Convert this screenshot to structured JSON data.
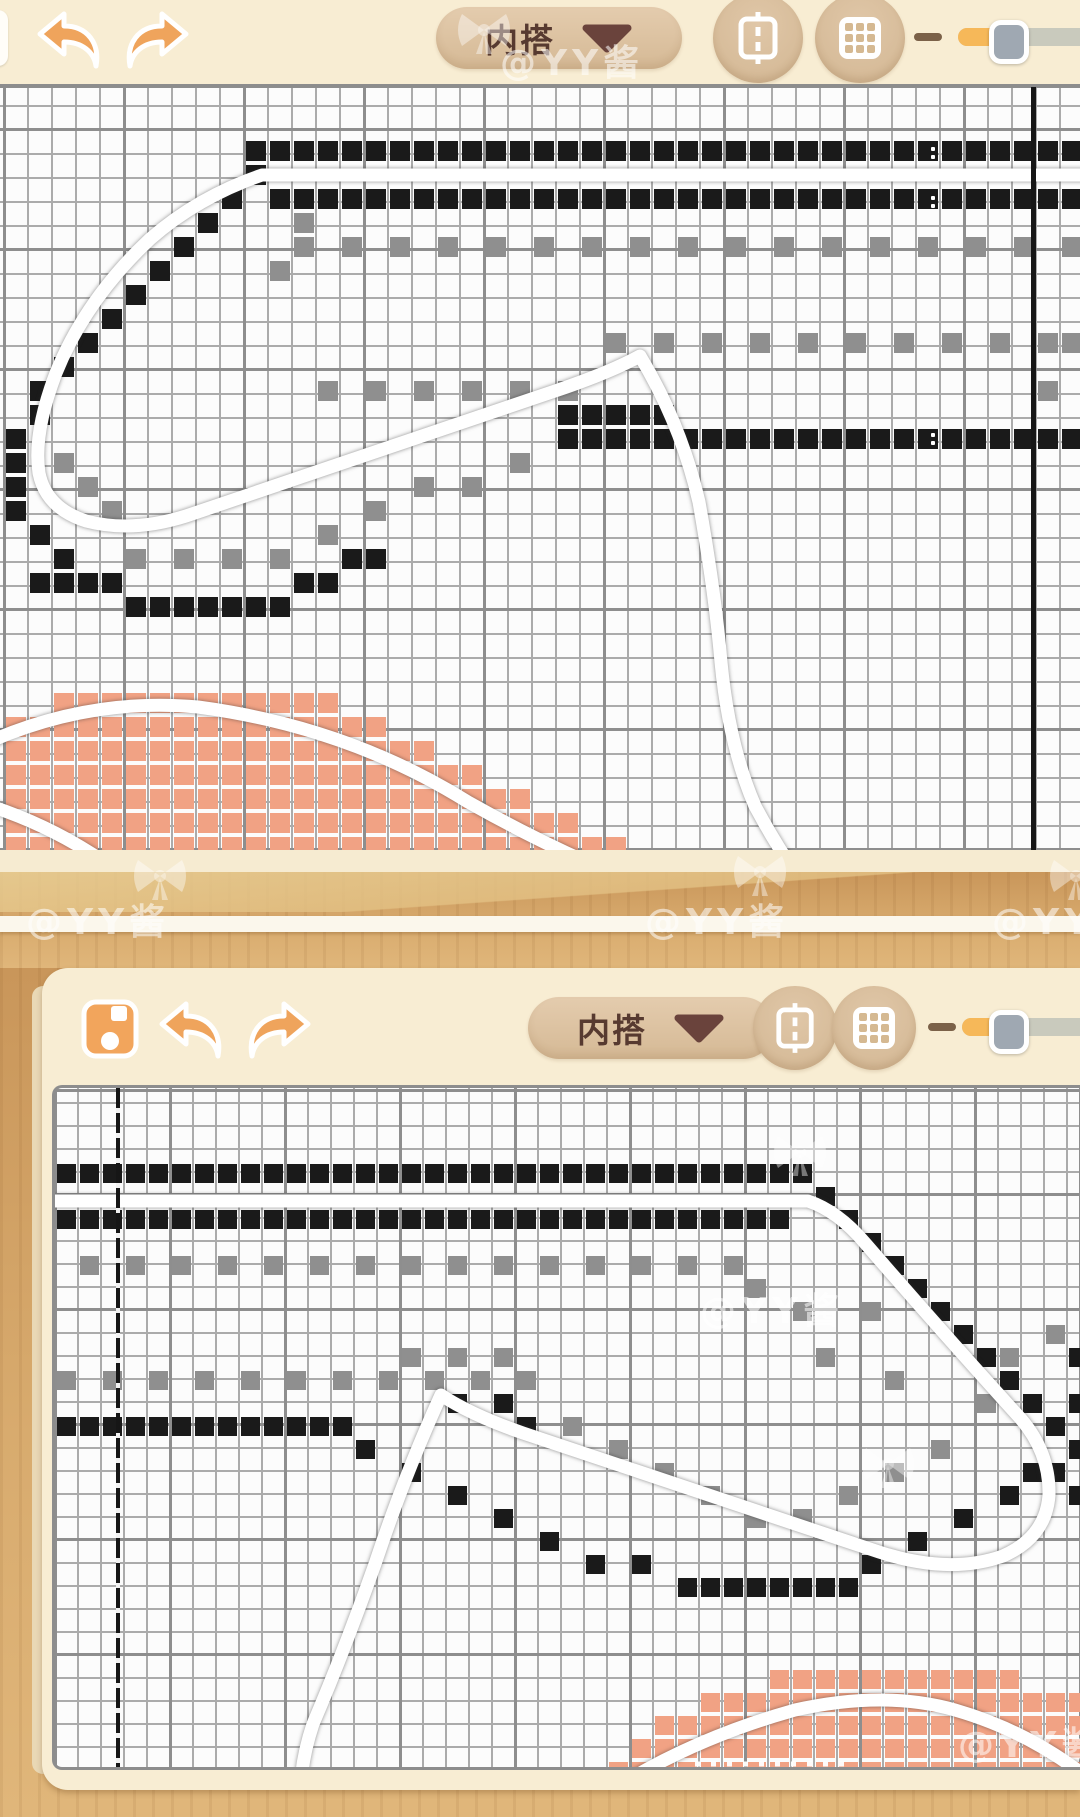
{
  "app": {
    "watermark_text": "@YY酱"
  },
  "colors": {
    "cream": "#f8edd3",
    "tan": "#d5b995",
    "dark_brown": "#573a30",
    "accent_orange": "#efa45c",
    "cell_black": "#1a1a1a",
    "cell_gray": "#8f8f8f",
    "cell_orange": "#f1a284",
    "wood": "#d8ab6e",
    "slider_fill": "#f6b859",
    "slider_track": "#c9cabd",
    "slider_thumb": "#9fa8b2",
    "white_line": "#ffffff"
  },
  "panel1": {
    "toolbar": {
      "layer_label": "内搭",
      "slider_percent": 30
    },
    "canvas": {
      "cell": 24,
      "origin_x": 4,
      "origin_y": 4,
      "cols": 45,
      "marker_line_x": 1031,
      "dot_marks": [
        [
          931,
          60
        ],
        [
          931,
          68
        ],
        [
          931,
          109
        ],
        [
          931,
          117
        ],
        [
          931,
          346
        ],
        [
          931,
          354
        ]
      ],
      "pattern": {
        "black_runs": [
          [
            2,
            10,
            44
          ],
          [
            4,
            11,
            44
          ],
          [
            13,
            24,
            27
          ],
          [
            14,
            23,
            44
          ],
          [
            21,
            6,
            11
          ]
        ],
        "black_cells": [
          [
            10,
            3
          ],
          [
            9,
            4
          ],
          [
            8,
            5
          ],
          [
            7,
            6
          ],
          [
            6,
            7
          ],
          [
            5,
            8
          ],
          [
            4,
            9
          ],
          [
            3,
            10
          ],
          [
            2,
            11
          ],
          [
            1,
            12
          ],
          [
            1,
            13
          ],
          [
            0,
            14
          ],
          [
            0,
            15
          ],
          [
            0,
            16
          ],
          [
            0,
            17
          ],
          [
            1,
            18
          ],
          [
            2,
            19
          ],
          [
            1,
            20
          ],
          [
            2,
            20
          ],
          [
            3,
            20
          ],
          [
            4,
            20
          ],
          [
            5,
            21
          ],
          [
            12,
            20
          ],
          [
            13,
            20
          ],
          [
            14,
            19
          ],
          [
            15,
            19
          ],
          [
            23,
            13
          ]
        ],
        "gray_runs": [
          [
            6,
            12,
            44,
            2
          ],
          [
            10,
            25,
            43,
            2
          ],
          [
            12,
            13,
            23,
            2
          ],
          [
            19,
            5,
            11,
            2
          ]
        ],
        "gray_cells": [
          [
            12,
            5
          ],
          [
            11,
            7
          ],
          [
            2,
            15
          ],
          [
            3,
            16
          ],
          [
            4,
            17
          ],
          [
            13,
            18
          ],
          [
            15,
            17
          ],
          [
            17,
            16
          ],
          [
            19,
            16
          ],
          [
            21,
            15
          ],
          [
            44,
            10
          ],
          [
            43,
            12
          ]
        ],
        "orange_runs": [
          [
            25,
            2,
            13
          ],
          [
            26,
            0,
            15
          ],
          [
            27,
            0,
            17
          ],
          [
            28,
            0,
            19
          ],
          [
            29,
            0,
            21
          ],
          [
            30,
            0,
            23
          ],
          [
            31,
            0,
            25
          ]
        ]
      },
      "white_paths": [
        {
          "d": "M 1092,88 L 262,88 Q 198,110 150,152 Q 86,212 56,286 Q 33,346 39,386 Q 46,421 86,434 Q 132,446 186,429 L 558,303 Q 611,285 640,269 Q 681,337 699,415 Q 715,505 721,575 Q 729,659 755,719 Q 771,749 790,778",
          "cls": "outline"
        },
        {
          "d": "M -16,657 Q 88,610 198,620 Q 348,640 468,715 Q 562,768 652,802",
          "cls": "outline"
        },
        {
          "d": "M -16,717 Q 42,735 92,767 Q 114,781 130,797",
          "cls": "outline"
        }
      ]
    }
  },
  "panel2": {
    "toolbar": {
      "layer_label": "内搭",
      "slider_percent": 28
    },
    "canvas": {
      "cell": 23,
      "origin_x": 0,
      "origin_y": 5,
      "cols": 45,
      "marker_line_x": 61,
      "dot_marks": [],
      "pattern": {
        "black_runs": [
          [
            3,
            0,
            32
          ],
          [
            5,
            0,
            31
          ],
          [
            14,
            0,
            12
          ],
          [
            21,
            29,
            34
          ]
        ],
        "black_cells": [
          [
            33,
            4
          ],
          [
            34,
            5
          ],
          [
            35,
            6
          ],
          [
            36,
            7
          ],
          [
            37,
            8
          ],
          [
            38,
            9
          ],
          [
            39,
            10
          ],
          [
            40,
            11
          ],
          [
            41,
            12
          ],
          [
            42,
            13
          ],
          [
            43,
            14
          ],
          [
            44,
            15
          ],
          [
            44,
            13
          ],
          [
            43,
            16
          ],
          [
            44,
            17
          ],
          [
            44,
            11
          ],
          [
            17,
            13
          ],
          [
            19,
            13
          ],
          [
            20,
            14
          ],
          [
            13,
            15
          ],
          [
            15,
            16
          ],
          [
            17,
            17
          ],
          [
            19,
            18
          ],
          [
            21,
            19
          ],
          [
            23,
            20
          ],
          [
            25,
            20
          ],
          [
            27,
            21
          ],
          [
            28,
            21
          ],
          [
            35,
            20
          ],
          [
            37,
            19
          ],
          [
            39,
            18
          ],
          [
            41,
            17
          ],
          [
            42,
            16
          ]
        ],
        "gray_runs": [
          [
            7,
            1,
            29,
            2
          ],
          [
            12,
            0,
            20,
            2
          ]
        ],
        "gray_cells": [
          [
            15,
            11
          ],
          [
            17,
            11
          ],
          [
            19,
            11
          ],
          [
            30,
            8
          ],
          [
            32,
            9
          ],
          [
            35,
            9
          ],
          [
            33,
            11
          ],
          [
            36,
            12
          ],
          [
            24,
            15
          ],
          [
            26,
            16
          ],
          [
            28,
            17
          ],
          [
            30,
            18
          ],
          [
            32,
            18
          ],
          [
            34,
            17
          ],
          [
            36,
            16
          ],
          [
            38,
            15
          ],
          [
            40,
            13
          ],
          [
            41,
            11
          ],
          [
            22,
            14
          ],
          [
            43,
            10
          ]
        ],
        "orange_runs": [
          [
            25,
            31,
            41
          ],
          [
            26,
            28,
            44
          ],
          [
            27,
            26,
            44
          ],
          [
            28,
            25,
            44
          ],
          [
            29,
            24,
            44
          ]
        ]
      },
      "white_paths": [
        {
          "d": "M -14,113 L 753,113 Q 783,123 810,155 Q 888,245 966,331 Q 995,365 994,407 Q 991,449 948,468 Q 894,487 824,464 L 468,345 Q 416,327 386,307 Q 350,386 320,476 Q 288,566 258,636 Q 248,666 246,694",
          "cls": "outline"
        },
        {
          "d": "M 560,700 Q 640,650 740,622 Q 830,602 900,622 Q 980,645 1045,700",
          "cls": "outline"
        },
        {
          "d": "M 640,676 L 790,676",
          "cls": "dotted"
        }
      ]
    }
  },
  "watermarks": [
    {
      "type": "bow",
      "x": 452,
      "y": 6
    },
    {
      "type": "text",
      "x": 500,
      "y": 34
    },
    {
      "type": "bow",
      "x": 128,
      "y": 852
    },
    {
      "type": "bow",
      "x": 728,
      "y": 848
    },
    {
      "type": "bow",
      "x": 1044,
      "y": 852
    },
    {
      "type": "text",
      "x": 26,
      "y": 893
    },
    {
      "type": "text",
      "x": 645,
      "y": 893
    },
    {
      "type": "text",
      "x": 992,
      "y": 893
    },
    {
      "type": "bow",
      "x": 768,
      "y": 1128
    },
    {
      "type": "text",
      "x": 700,
      "y": 1282
    },
    {
      "type": "bow",
      "x": 856,
      "y": 1440
    },
    {
      "type": "text",
      "x": 958,
      "y": 1716
    }
  ]
}
